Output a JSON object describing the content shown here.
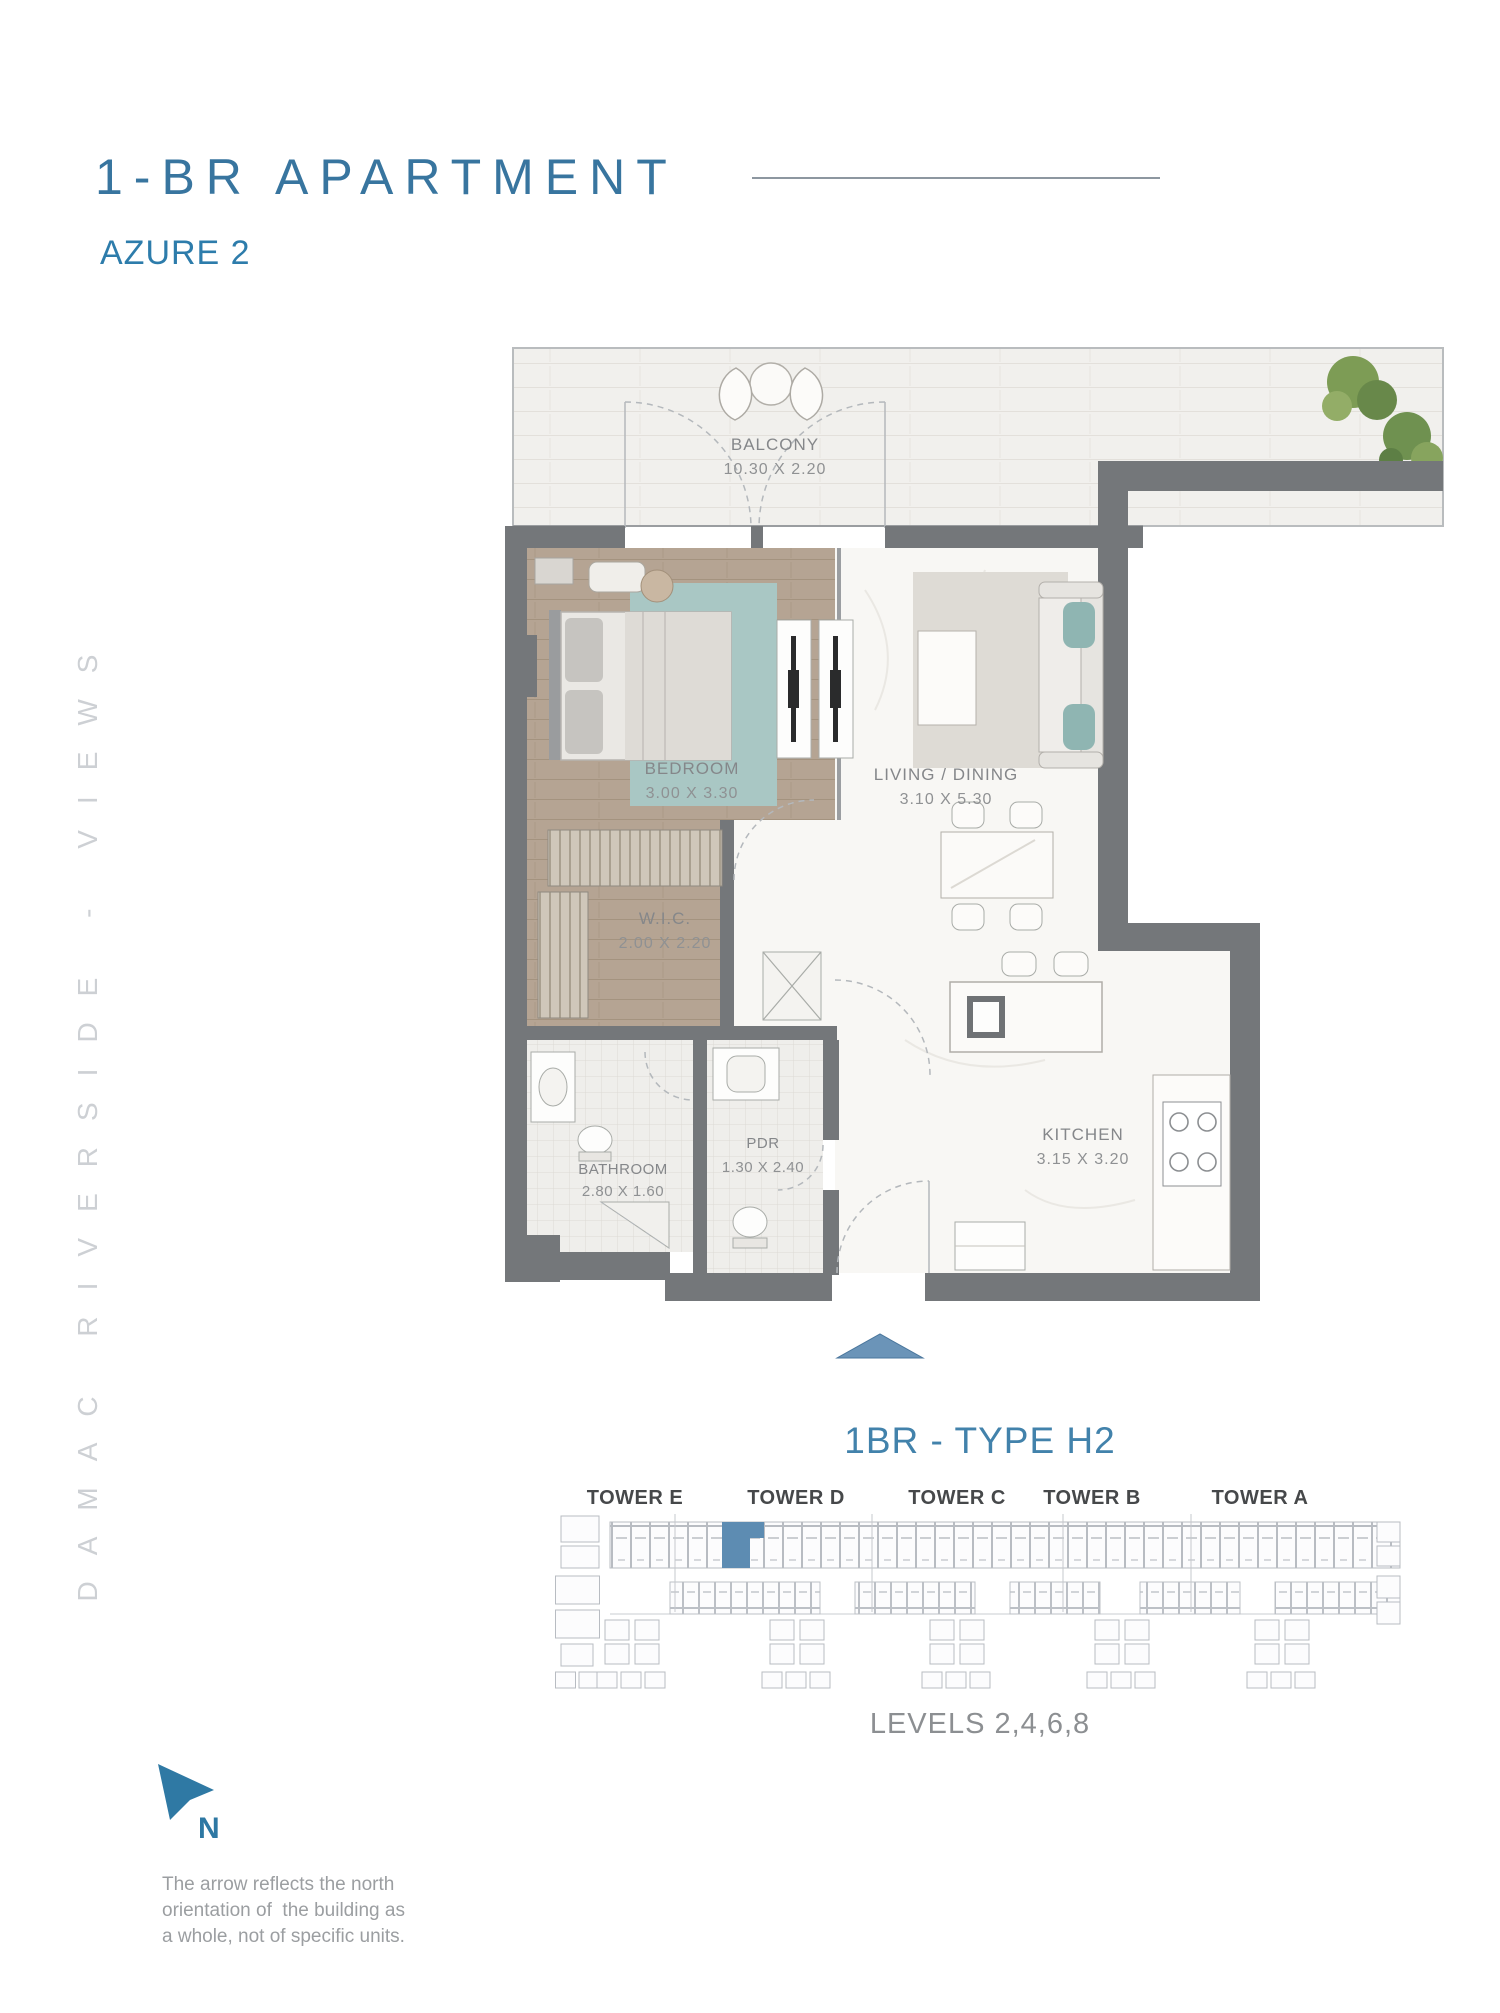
{
  "header": {
    "title": "1-BR APARTMENT",
    "subtitle": "AZURE 2"
  },
  "side_text": "DAMAC RIVERSIDE - VIEWS",
  "floor_plan": {
    "balcony": {
      "name": "BALCONY",
      "dims": "10.30 X 2.20"
    },
    "bedroom": {
      "name": "BEDROOM",
      "dims": "3.00 X 3.30"
    },
    "living": {
      "name": "LIVING / DINING",
      "dims": "3.10 X 5.30"
    },
    "wic": {
      "name": "W.I.C.",
      "dims": "2.00 X 2.20"
    },
    "bathroom": {
      "name": "BATHROOM",
      "dims": "2.80 X 1.60"
    },
    "pdr": {
      "name": "PDR",
      "dims": "1.30 X 2.40"
    },
    "kitchen": {
      "name": "KITCHEN",
      "dims": "3.15 X 3.20"
    }
  },
  "unit": {
    "type_heading": "1BR - TYPE H2",
    "levels": "LEVELS 2,4,6,8"
  },
  "towers": {
    "labels": [
      "TOWER E",
      "TOWER D",
      "TOWER C",
      "TOWER B",
      "TOWER A"
    ],
    "highlighted_tower": "TOWER D"
  },
  "compass": {
    "label": "N"
  },
  "footnote": {
    "line1": "The arrow reflects the north",
    "line2": "orientation of  the building as",
    "line3": "a whole, not of specific units."
  },
  "colors": {
    "accent_blue": "#38759f",
    "subtitle_blue": "#2d7cab",
    "wall_gray": "#74777a",
    "highlight_unit_blue": "#5d8cb2",
    "entry_arrow_blue": "#6b94b8",
    "bedroom_floor_tan": "#b5a493",
    "rug_teal": "#a5c4c2"
  }
}
